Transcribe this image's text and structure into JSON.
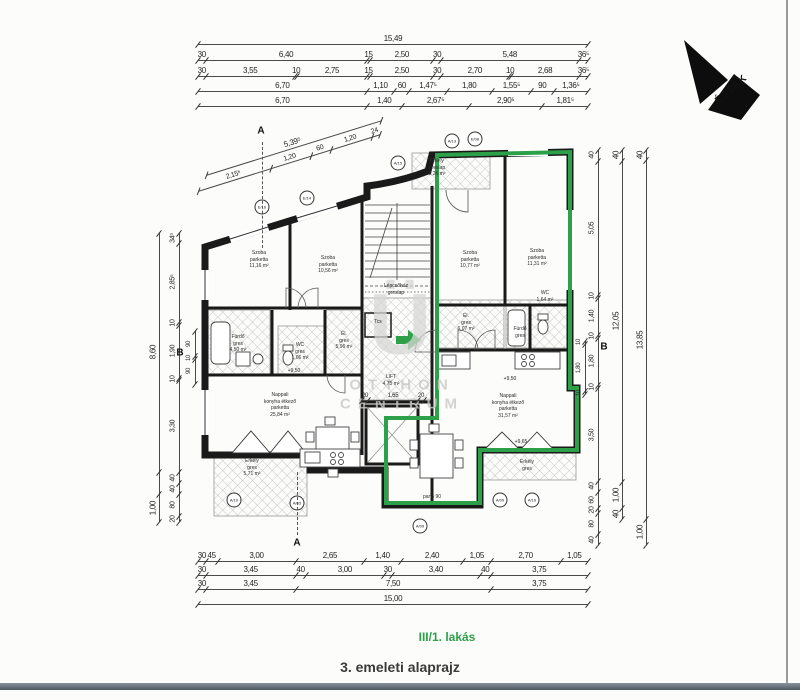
{
  "labels": {
    "apartment": "III/1. lakás",
    "plan_title": "3. emeleti alaprajz",
    "north": "ÉSZAK",
    "watermark_logo": "Ü",
    "watermark_line1": "OTTHON",
    "watermark_line2": "CENTRUM"
  },
  "colors": {
    "accent_green": "#2da04a",
    "wall": "#1a1a1a",
    "dim": "#4a4a4a",
    "watermark": "#c9c9c7"
  },
  "rooms": [
    {
      "text": "Szoba\nparketta\n11,16 m²",
      "x": 259,
      "y": 250
    },
    {
      "text": "Szoba\nparketta\n10,56 m²",
      "x": 328,
      "y": 255
    },
    {
      "text": "Szoba\nparketta\n10,77 m²",
      "x": 470,
      "y": 250
    },
    {
      "text": "Szoba\nparketta\n11,31 m²",
      "x": 537,
      "y": 248
    },
    {
      "text": "Fürdő\ngres\n4,50 m²",
      "x": 238,
      "y": 334
    },
    {
      "text": "WC\ngres\n1,06 m²",
      "x": 300,
      "y": 342
    },
    {
      "text": "Él.\ngres\n5,96 m²",
      "x": 344,
      "y": 331
    },
    {
      "text": "Él.\ngres\n6,07 m²",
      "x": 466,
      "y": 313
    },
    {
      "text": "WC\n1,64 m²",
      "x": 545,
      "y": 290
    },
    {
      "text": "Fürdő\ngres",
      "x": 520,
      "y": 326
    },
    {
      "text": "Nappali\nkonyha étkező\nparketta\n25,84 m²",
      "x": 280,
      "y": 392
    },
    {
      "text": "Nappali\nkonyha étkező\nparketta\n31,57 m²",
      "x": 508,
      "y": 393
    },
    {
      "text": "Erkély\ngreslap\n3,26 m²",
      "x": 437,
      "y": 158
    },
    {
      "text": "Erkély\ngres\n5,71 m²",
      "x": 252,
      "y": 458
    },
    {
      "text": "Erkély\ngres",
      "x": 527,
      "y": 459
    },
    {
      "text": "Lépcsőház\ngreslap",
      "x": 396,
      "y": 283
    },
    {
      "text": "LIFT\n4,75 m²",
      "x": 391,
      "y": 374
    },
    {
      "text": "Tcs",
      "x": 378,
      "y": 319
    },
    {
      "text": "pano 90",
      "x": 432,
      "y": 494
    }
  ],
  "level_marks": [
    {
      "text": "+9,50",
      "x": 294,
      "y": 371
    },
    {
      "text": "+9,50",
      "x": 510,
      "y": 379
    },
    {
      "text": "+9,65",
      "x": 521,
      "y": 442
    }
  ],
  "markers": [
    {
      "text": "E/16",
      "x": 262,
      "y": 207
    },
    {
      "text": "E/14",
      "x": 307,
      "y": 198
    },
    {
      "text": "A/15",
      "x": 398,
      "y": 163
    },
    {
      "text": "A/13",
      "x": 452,
      "y": 141
    },
    {
      "text": "E/08",
      "x": 475,
      "y": 139
    },
    {
      "text": "A/10",
      "x": 234,
      "y": 500
    },
    {
      "text": "A/03",
      "x": 297,
      "y": 503
    },
    {
      "text": "A/09",
      "x": 420,
      "y": 526
    },
    {
      "text": "A/09",
      "x": 500,
      "y": 500
    },
    {
      "text": "A/16",
      "x": 532,
      "y": 500
    }
  ],
  "section_marks": [
    {
      "text": "A",
      "x": 261,
      "y": 131,
      "dash": {
        "x": 262,
        "y0": 142,
        "y1": 248
      }
    },
    {
      "text": "A",
      "x": 297,
      "y": 543,
      "dash": {
        "x": 297,
        "y0": 472,
        "y1": 535
      }
    },
    {
      "text": "B",
      "x": 180,
      "y": 353,
      "dash": null
    },
    {
      "text": "B",
      "x": 604,
      "y": 347,
      "dash": null
    }
  ],
  "dims": {
    "horizontal": [
      {
        "y": 40,
        "x0": 198,
        "x1": 588,
        "f": 8,
        "segs": [
          [
            "15,49",
            15.495
          ]
        ]
      },
      {
        "y": 56,
        "x0": 198,
        "x1": 588,
        "f": 8,
        "segs": [
          [
            "30",
            0.3
          ],
          [
            "6,40",
            6.4
          ],
          [
            "15",
            0.15
          ],
          [
            "2,50",
            2.5
          ],
          [
            "30",
            0.3
          ],
          [
            "5,48",
            5.48
          ],
          [
            "36⁵",
            0.365
          ]
        ]
      },
      {
        "y": 72,
        "x0": 198,
        "x1": 588,
        "f": 8,
        "segs": [
          [
            "30",
            0.3
          ],
          [
            "3,55",
            3.55
          ],
          [
            "10",
            0.1
          ],
          [
            "2,75",
            2.75
          ],
          [
            "15",
            0.15
          ],
          [
            "2,50",
            2.5
          ],
          [
            "30",
            0.3
          ],
          [
            "2,70",
            2.7
          ],
          [
            "10",
            0.1
          ],
          [
            "2,68",
            2.68
          ],
          [
            "36⁵",
            0.365
          ]
        ]
      },
      {
        "y": 87,
        "x0": 198,
        "x1": 588,
        "f": 8,
        "segs": [
          [
            "6,70",
            6.7
          ],
          [
            "1,10",
            1.1
          ],
          [
            "60",
            0.6
          ],
          [
            "1,47⁵",
            1.475
          ],
          [
            "1,80",
            1.8
          ],
          [
            "1,55⁵",
            1.555
          ],
          [
            "90",
            0.9
          ],
          [
            "1,36⁵",
            1.365
          ]
        ]
      },
      {
        "y": 102,
        "x0": 198,
        "x1": 588,
        "f": 8,
        "segs": [
          [
            "6,70",
            6.7
          ],
          [
            "1,40",
            1.4
          ],
          [
            "2,67⁵",
            2.675
          ],
          [
            "2,90⁵",
            2.905
          ],
          [
            "1,81⁵",
            1.815
          ]
        ]
      },
      {
        "y": 557,
        "x0": 198,
        "x1": 588,
        "f": 8,
        "segs": [
          [
            "30",
            0.3
          ],
          [
            "45",
            0.45
          ],
          [
            "3,00",
            3.0
          ],
          [
            "2,65",
            2.65
          ],
          [
            "1,40",
            1.4
          ],
          [
            "2,40",
            2.4
          ],
          [
            "1,05",
            1.05
          ],
          [
            "2,70",
            2.7
          ],
          [
            "1,05",
            1.05
          ]
        ]
      },
      {
        "y": 571,
        "x0": 198,
        "x1": 588,
        "f": 8,
        "segs": [
          [
            "30",
            0.3
          ],
          [
            "3,45",
            3.45
          ],
          [
            "40",
            0.4
          ],
          [
            "3,00",
            3.0
          ],
          [
            "30",
            0.3
          ],
          [
            "3,40",
            3.4
          ],
          [
            "40",
            0.4
          ],
          [
            "3,75",
            3.75
          ]
        ]
      },
      {
        "y": 585,
        "x0": 198,
        "x1": 588,
        "f": 8,
        "segs": [
          [
            "30",
            0.3
          ],
          [
            "3,45",
            3.45
          ],
          [
            "7,50",
            7.5
          ],
          [
            "3,75",
            3.75
          ]
        ]
      },
      {
        "y": 600,
        "x0": 198,
        "x1": 588,
        "f": 8,
        "segs": [
          [
            "15,00",
            15.0
          ]
        ]
      },
      {
        "y": 396,
        "x0": 362,
        "x1": 424,
        "f": 6,
        "segs": [
          [
            "20",
            0.2
          ],
          [
            "1,65",
            1.65
          ],
          [
            "20",
            0.2
          ]
        ]
      }
    ],
    "vertical": [
      {
        "x": 159,
        "y0": 233,
        "y1": 522,
        "f": 8,
        "segs": [
          [
            "8,60",
            8.6
          ],
          [
            "",
            0.8
          ],
          [
            "1,00",
            1.0
          ]
        ]
      },
      {
        "x": 179,
        "y0": 233,
        "y1": 522,
        "f": 7,
        "segs": [
          [
            "34⁵",
            0.345
          ],
          [
            "2,85⁵",
            2.855
          ],
          [
            "10",
            0.1
          ],
          [
            "1,90",
            1.9
          ],
          [
            "10",
            0.1
          ],
          [
            "3,30",
            3.3
          ],
          [
            "40",
            0.4
          ],
          [
            "40",
            0.4
          ],
          [
            "80",
            0.8
          ],
          [
            "20",
            0.2
          ]
        ]
      },
      {
        "x": 195,
        "y0": 331,
        "y1": 384,
        "f": 6,
        "segs": [
          [
            "90",
            0.9
          ],
          [
            "10",
            0.1
          ],
          [
            "90",
            0.9
          ]
        ]
      },
      {
        "x": 598,
        "y0": 150,
        "y1": 545,
        "f": 7,
        "segs": [
          [
            "40",
            0.4
          ],
          [
            "5,05",
            5.05
          ],
          [
            "10",
            0.1
          ],
          [
            "1,40",
            1.4
          ],
          [
            "10",
            0.1
          ],
          [
            "1,80",
            1.8
          ],
          [
            "10",
            0.1
          ],
          [
            "3,50",
            3.5
          ],
          [
            "40",
            0.4
          ],
          [
            "60",
            0.6
          ],
          [
            "20",
            0.2
          ],
          [
            "80",
            0.8
          ],
          [
            "40",
            0.4
          ]
        ]
      },
      {
        "x": 622,
        "y0": 150,
        "y1": 519,
        "f": 8,
        "segs": [
          [
            "40",
            0.4
          ],
          [
            "12,05",
            12.05
          ],
          [
            "1,00",
            1.0
          ],
          [
            "40",
            0.4
          ]
        ]
      },
      {
        "x": 646,
        "y0": 150,
        "y1": 545,
        "f": 8,
        "segs": [
          [
            "40",
            0.4
          ],
          [
            "13,85",
            13.85
          ],
          [
            "1,00",
            1.0
          ]
        ]
      },
      {
        "x": 585,
        "y0": 341,
        "y1": 394,
        "f": 6,
        "segs": [
          [
            "10",
            0.1
          ],
          [
            "1,80",
            1.8
          ],
          [
            "10",
            0.1
          ]
        ]
      }
    ],
    "slanted": [
      {
        "x0": 205,
        "y0": 163,
        "angle": -17.3,
        "len": 183,
        "f": 8,
        "segs": [
          [
            "5,39⁵",
            5.395
          ]
        ]
      },
      {
        "x0": 197,
        "y0": 179,
        "angle": -17.3,
        "len": 190,
        "f": 7,
        "segs": [
          [
            "2,15⁵",
            2.155
          ],
          [
            "1,20",
            1.2
          ],
          [
            "60",
            0.6
          ],
          [
            "1,20",
            1.2
          ],
          [
            "24",
            0.24
          ]
        ]
      }
    ]
  }
}
